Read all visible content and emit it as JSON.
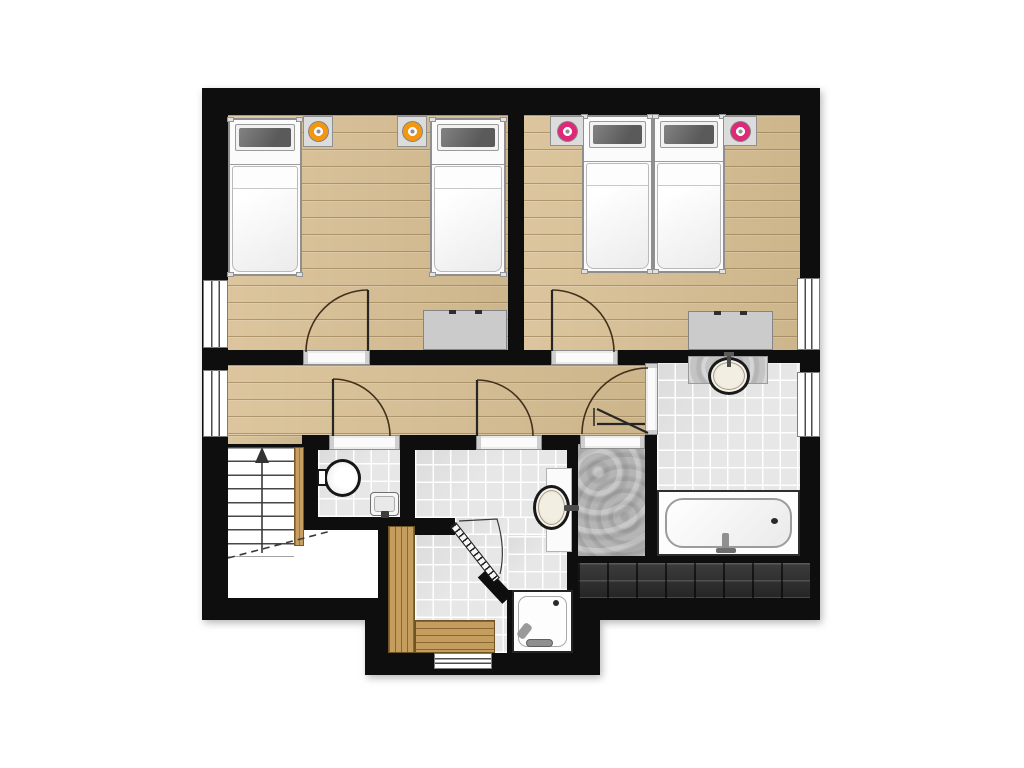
{
  "title": "attic-floor-plan",
  "canvas": {
    "width": 1024,
    "height": 768,
    "background": "#ffffff"
  },
  "colors": {
    "wall": "#0e0e0e",
    "wood": "#d8bf93",
    "tile": "#e7e7e7",
    "stone": "#b5b5b5",
    "roof": "#2d2d2d",
    "bench": "#c59e5f",
    "accent_orange": "#f2970f",
    "accent_pink": "#e02878",
    "arc": "#42301c",
    "leaf": "#262626",
    "thin": "#3a3a3a"
  },
  "rooms": [
    {
      "name": "bedroom-left",
      "floor": "wood",
      "contents": [
        "bed-1",
        "bed-2",
        "nightstand-1",
        "nightstand-2",
        "dresser-left"
      ]
    },
    {
      "name": "bedroom-right",
      "floor": "wood",
      "contents": [
        "bed-3",
        "bed-4",
        "nightstand-3",
        "nightstand-4",
        "dresser-right"
      ]
    },
    {
      "name": "hallway",
      "floor": "wood",
      "contents": []
    },
    {
      "name": "wc",
      "floor": "tile",
      "contents": [
        "toilet",
        "wc-sink"
      ]
    },
    {
      "name": "bathroom-middle",
      "floor": "tile",
      "contents": [
        "vanity-middle",
        "sink-middle",
        "shower-tray"
      ]
    },
    {
      "name": "sauna-room",
      "floor": "tile",
      "contents": [
        "sauna-bench-left",
        "sauna-bench-bottom"
      ]
    },
    {
      "name": "bathroom-right",
      "floor": "tile",
      "contents": [
        "vanity-right",
        "sink-right",
        "bathtub"
      ]
    },
    {
      "name": "storage-room",
      "floor": "stone",
      "contents": []
    },
    {
      "name": "stairwell",
      "floor": "plain",
      "contents": [
        "stairs"
      ]
    },
    {
      "name": "roof-section",
      "floor": "roof",
      "contents": []
    }
  ],
  "layers": [
    {
      "kind": "wall",
      "name": "outer-structure-main",
      "x": 202,
      "y": 88,
      "w": 618,
      "h": 532
    },
    {
      "kind": "wall",
      "name": "outer-structure-bump",
      "x": 365,
      "y": 518,
      "w": 235,
      "h": 157
    },
    {
      "kind": "floor",
      "cls": "wood",
      "name": "bedroom-left-floor",
      "x": 228,
      "y": 115,
      "w": 280,
      "h": 235
    },
    {
      "kind": "floor",
      "cls": "wood",
      "name": "bedroom-right-floor",
      "x": 524,
      "y": 115,
      "w": 276,
      "h": 235
    },
    {
      "kind": "floor",
      "cls": "wood",
      "name": "hallway-floor",
      "x": 228,
      "y": 365,
      "w": 417,
      "h": 70
    },
    {
      "kind": "floor",
      "cls": "wood",
      "name": "hallway-stair-edge",
      "x": 228,
      "y": 435,
      "w": 74,
      "h": 9
    },
    {
      "kind": "floor",
      "cls": "tile",
      "name": "wc-floor",
      "x": 318,
      "y": 450,
      "w": 82,
      "h": 67
    },
    {
      "kind": "floor",
      "cls": "tile",
      "name": "bathroom-middle-floor",
      "x": 415,
      "y": 450,
      "w": 152,
      "h": 68
    },
    {
      "kind": "floor",
      "cls": "tile",
      "name": "bathroom-middle-floor-2",
      "x": 455,
      "y": 518,
      "w": 112,
      "h": 17
    },
    {
      "kind": "floor",
      "cls": "tile",
      "name": "sauna-floor",
      "x": 415,
      "y": 535,
      "w": 92,
      "h": 118
    },
    {
      "kind": "floor",
      "cls": "tile",
      "name": "shower-nook-floor",
      "x": 507,
      "y": 535,
      "w": 60,
      "h": 55
    },
    {
      "kind": "floor",
      "cls": "tile",
      "name": "bathroom-right-floor",
      "x": 657,
      "y": 363,
      "w": 143,
      "h": 193
    },
    {
      "kind": "floor",
      "cls": "stone",
      "name": "storage-room-floor",
      "x": 578,
      "y": 444,
      "w": 67,
      "h": 112
    },
    {
      "kind": "floor",
      "cls": "plain",
      "name": "stairwell-floor",
      "x": 228,
      "y": 447,
      "w": 74,
      "h": 151
    },
    {
      "kind": "floor",
      "cls": "plain",
      "name": "landing-floor",
      "x": 302,
      "y": 530,
      "w": 76,
      "h": 68
    },
    {
      "kind": "floor",
      "cls": "roof",
      "name": "roof-section-band",
      "x": 578,
      "y": 563,
      "w": 232,
      "h": 35
    },
    {
      "kind": "window",
      "o": "v",
      "name": "window-bedroom-left",
      "x": 203,
      "y": 280,
      "w": 25,
      "h": 68
    },
    {
      "kind": "window",
      "o": "v",
      "name": "window-hallway",
      "x": 203,
      "y": 370,
      "w": 25,
      "h": 67
    },
    {
      "kind": "window",
      "o": "v",
      "name": "window-bedroom-right",
      "x": 797,
      "y": 278,
      "w": 23,
      "h": 72
    },
    {
      "kind": "window",
      "o": "v",
      "name": "window-bathroom-right",
      "x": 797,
      "y": 372,
      "w": 23,
      "h": 65
    },
    {
      "kind": "window",
      "o": "h",
      "name": "window-sauna",
      "x": 434,
      "y": 653,
      "w": 58,
      "h": 16
    },
    {
      "kind": "threshold",
      "o": "h",
      "name": "door-sill-bedroom-left",
      "x": 303,
      "y": 350,
      "w": 67,
      "h": 15
    },
    {
      "kind": "threshold",
      "o": "h",
      "name": "door-sill-bedroom-right",
      "x": 551,
      "y": 350,
      "w": 67,
      "h": 15
    },
    {
      "kind": "threshold",
      "o": "h",
      "name": "door-sill-wc",
      "x": 329,
      "y": 435,
      "w": 71,
      "h": 15
    },
    {
      "kind": "threshold",
      "o": "h",
      "name": "door-sill-bathroom-middle",
      "x": 476,
      "y": 435,
      "w": 66,
      "h": 15
    },
    {
      "kind": "threshold",
      "o": "h",
      "name": "door-sill-storage",
      "x": 580,
      "y": 435,
      "w": 65,
      "h": 14
    },
    {
      "kind": "threshold",
      "o": "v",
      "name": "door-sill-bathroom-right",
      "x": 645,
      "y": 363,
      "w": 13,
      "h": 72
    },
    {
      "kind": "bed",
      "name": "bed-1",
      "x": 228,
      "y": 118,
      "w": 74,
      "h": 158
    },
    {
      "kind": "bed",
      "name": "bed-2",
      "x": 430,
      "y": 118,
      "w": 76,
      "h": 158
    },
    {
      "kind": "bed",
      "name": "bed-3",
      "x": 582,
      "y": 115,
      "w": 71,
      "h": 158
    },
    {
      "kind": "bed",
      "name": "bed-4",
      "x": 653,
      "y": 115,
      "w": 72,
      "h": 158
    },
    {
      "kind": "nightstand",
      "name": "nightstand-1",
      "x": 303,
      "y": 116,
      "w": 30,
      "h": 31,
      "c": "accent_orange"
    },
    {
      "kind": "nightstand",
      "name": "nightstand-2",
      "x": 397,
      "y": 116,
      "w": 30,
      "h": 31,
      "c": "accent_orange"
    },
    {
      "kind": "nightstand",
      "name": "nightstand-3",
      "x": 550,
      "y": 116,
      "w": 34,
      "h": 30,
      "c": "accent_pink"
    },
    {
      "kind": "nightstand",
      "name": "nightstand-4",
      "x": 723,
      "y": 116,
      "w": 34,
      "h": 30,
      "c": "accent_pink"
    },
    {
      "kind": "dresser",
      "name": "dresser-left",
      "x": 423,
      "y": 310,
      "w": 84,
      "h": 40
    },
    {
      "kind": "dresser",
      "name": "dresser-right",
      "x": 688,
      "y": 311,
      "w": 85,
      "h": 39
    },
    {
      "kind": "toilet",
      "name": "toilet",
      "x": 317,
      "y": 459,
      "w": 44,
      "h": 38
    },
    {
      "kind": "smallsink",
      "name": "wc-sink",
      "x": 370,
      "y": 492,
      "w": 29,
      "h": 24
    },
    {
      "kind": "counter",
      "name": "vanity-middle",
      "x": 546,
      "y": 468,
      "w": 26,
      "h": 84
    },
    {
      "kind": "ovalsink",
      "name": "sink-middle",
      "x": 533,
      "y": 485,
      "w": 37,
      "h": 45,
      "f": "right"
    },
    {
      "kind": "counter",
      "name": "vanity-right",
      "x": 688,
      "y": 356,
      "w": 80,
      "h": 28,
      "tex": true
    },
    {
      "kind": "ovalsink",
      "name": "sink-right",
      "x": 708,
      "y": 357,
      "w": 42,
      "h": 38,
      "f": "up"
    },
    {
      "kind": "tub",
      "name": "bathtub",
      "x": 657,
      "y": 490,
      "w": 143,
      "h": 66
    },
    {
      "kind": "tray",
      "name": "shower-tray",
      "x": 512,
      "y": 590,
      "w": 61,
      "h": 63
    },
    {
      "kind": "bench",
      "o": "v",
      "name": "sauna-bench-left",
      "x": 388,
      "y": 526,
      "w": 27,
      "h": 127
    },
    {
      "kind": "bench",
      "o": "h",
      "name": "sauna-bench-bottom",
      "x": 415,
      "y": 620,
      "w": 80,
      "h": 33
    },
    {
      "kind": "stairs",
      "name": "stairs",
      "x": 228,
      "y": 447,
      "w": 66,
      "h": 110
    },
    {
      "kind": "stringer",
      "name": "stair-stringer",
      "x": 294,
      "y": 447,
      "w": 10,
      "h": 99
    },
    {
      "kind": "rotwall",
      "name": "wall-stub-diagonal",
      "x": 488,
      "y": 568,
      "w": 36,
      "h": 14,
      "r": 47
    },
    {
      "kind": "doorleaf",
      "name": "sauna-door-leaf",
      "x": 456,
      "y": 522,
      "w": 71,
      "h": 8,
      "r": 51.8
    }
  ],
  "strokes": [
    {
      "name": "door-arc-bedroom-left",
      "d": "M368,290 A62,62 0 0 0 306,352",
      "s": "arc",
      "w": 1.6
    },
    {
      "name": "door-leaf-bedroom-left",
      "d": "M368,290 L368,351",
      "s": "leaf",
      "w": 2.2
    },
    {
      "name": "door-arc-bedroom-right",
      "d": "M552,290 A62,62 0 0 1 614,352",
      "s": "arc",
      "w": 1.6
    },
    {
      "name": "door-leaf-bedroom-right",
      "d": "M552,290 L552,351",
      "s": "leaf",
      "w": 2.2
    },
    {
      "name": "door-arc-wc",
      "d": "M333,379 A57,57 0 0 1 390,436",
      "s": "arc",
      "w": 1.6
    },
    {
      "name": "door-leaf-wc",
      "d": "M333,379 L333,436",
      "s": "leaf",
      "w": 2.2
    },
    {
      "name": "door-arc-bathroom-middle",
      "d": "M477,380 A56,56 0 0 1 533,436",
      "s": "arc",
      "w": 1.6
    },
    {
      "name": "door-leaf-bathroom-middle",
      "d": "M477,380 L477,436",
      "s": "leaf",
      "w": 2.2
    },
    {
      "name": "door-arc-bathroom-right",
      "d": "M648,368 A66,66 0 0 0 582,434",
      "s": "arc",
      "w": 1.6
    },
    {
      "name": "door-leaf-bathroom-right",
      "d": "M648,433 L597,409",
      "s": "leaf",
      "w": 2.2
    },
    {
      "name": "door-leaf-storage",
      "d": "M597,424 L645,424",
      "s": "leaf",
      "w": 2.2
    },
    {
      "name": "door-pivot-storage",
      "d": "M594,408 L594,426",
      "s": "leaf",
      "w": 1.5
    },
    {
      "name": "sauna-door-swing",
      "d": "M459,521 L497,519 Q506,549 500,574",
      "s": "thin",
      "w": 1.2
    },
    {
      "name": "stair-cut-line",
      "d": "M228,558 L331,531",
      "s": "thin",
      "w": 1.6,
      "dash": "7 5"
    },
    {
      "name": "stair-arrow-line",
      "d": "M262,553 L262,459",
      "s": "thin",
      "w": 1.6
    }
  ],
  "arrow_head": {
    "name": "stair-arrow-head",
    "points": "255,463 262,447 269,463",
    "fill": "#333333"
  }
}
